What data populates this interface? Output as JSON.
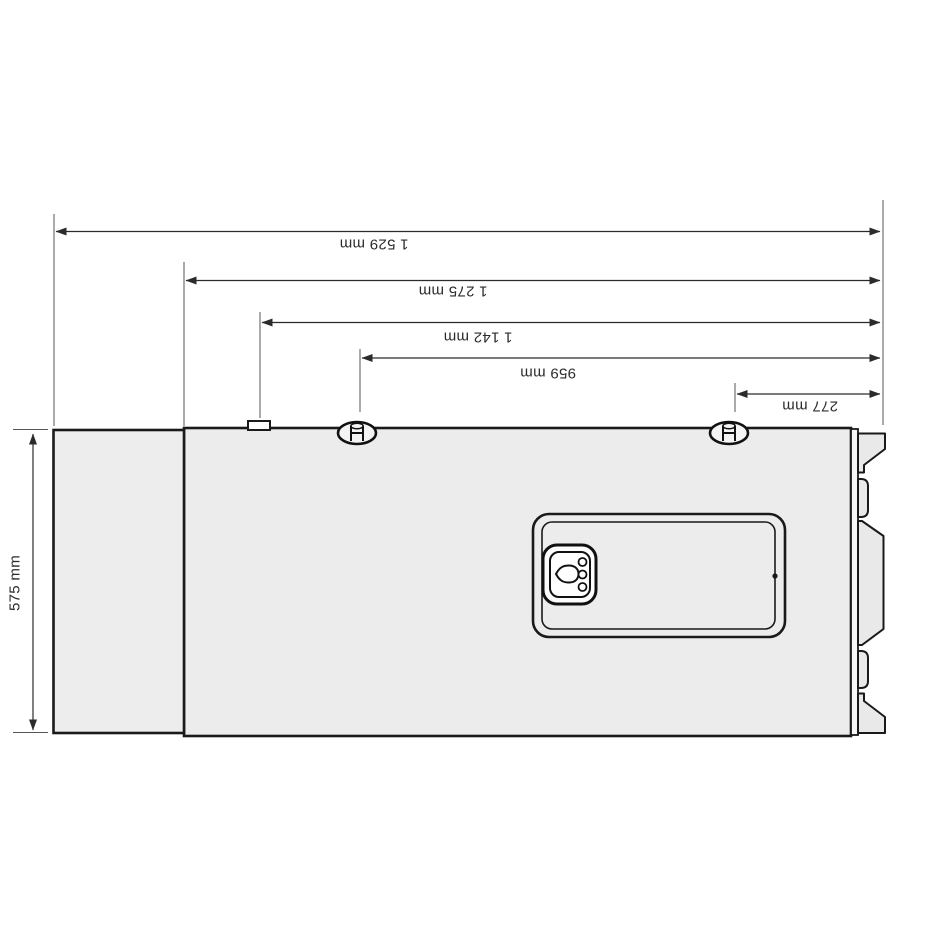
{
  "diagram": {
    "title": "appliance-dimension-drawing",
    "labels": {
      "dim_1529": "1 529 mm",
      "dim_1275": "1 275 mm",
      "dim_1142": "1 142 mm",
      "dim_959": "959 mm",
      "dim_277": "277 mm",
      "dim_575": "575 mm",
      "dim_1000": "1 000 mm"
    },
    "icons": {
      "control_icon": "water-drop-icon",
      "indicator_icon": "three-dot-indicator",
      "fastener_icon": "screw-cap"
    },
    "colors": {
      "line": "#2b2b2b",
      "body_fill": "#ececec",
      "panel_fill": "#ffffff",
      "background": "#ffffff"
    }
  }
}
